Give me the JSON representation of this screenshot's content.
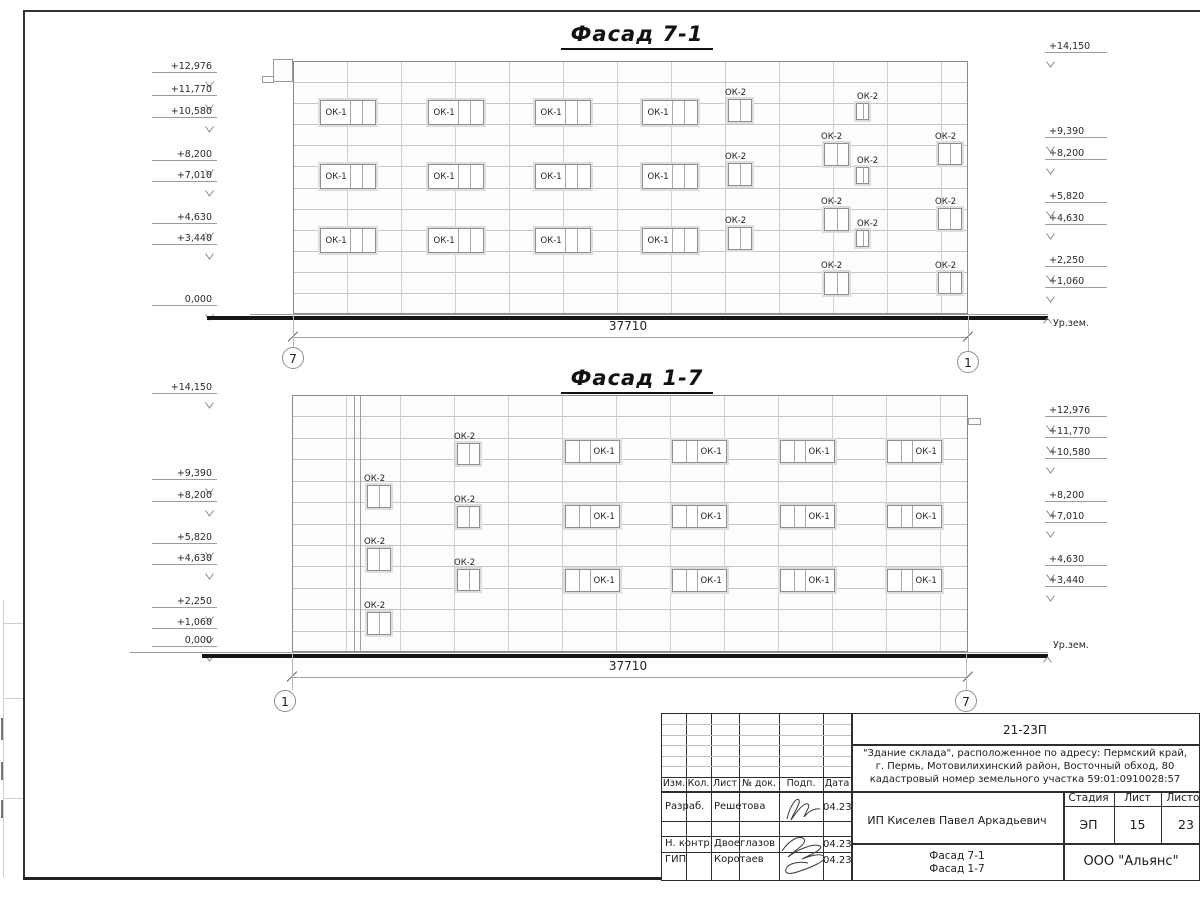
{
  "colors": {
    "line_dark": "#1a1a1a",
    "line_light": "#c4c4c4",
    "frame": "#2e2e2e"
  },
  "facades": [
    {
      "title": "Фасад 7-1",
      "title_cx": 637,
      "title_top": 22,
      "rect": {
        "x0": 293,
        "y0": 61,
        "x1": 968,
        "y1": 314
      },
      "grid": {
        "vstep": 54,
        "rows": 12
      },
      "extra_verticals": [],
      "ledges": [
        {
          "x": 273,
          "y": 59,
          "w": 20,
          "h": 23
        },
        {
          "x": 262,
          "y": 76,
          "w": 12,
          "h": 7
        }
      ],
      "ok1": {
        "label": "ОК-1",
        "cols": [
          320,
          428,
          535,
          642
        ],
        "rows": [
          100,
          164,
          228
        ],
        "w": 56,
        "h": 25,
        "side": "left"
      },
      "ok2": {
        "label": "ОК-2",
        "groups": [
          {
            "x": 728,
            "rows": [
              99,
              163,
              227
            ],
            "w": 24,
            "h": 23
          },
          {
            "x": 824,
            "rows": [
              143,
              208,
              272
            ],
            "w": 25,
            "h": 23
          },
          {
            "x": 856,
            "rows": [
              103,
              167,
              230
            ],
            "w": 13,
            "h": 17
          },
          {
            "x": 938,
            "rows": [
              143,
              208,
              272
            ],
            "w": 24,
            "h": 22
          }
        ]
      },
      "left_marks": [
        {
          "label": "+12,976",
          "y": 67
        },
        {
          "label": "+11,770",
          "y": 90
        },
        {
          "label": "+10,580",
          "y": 112
        },
        {
          "label": "+8,200",
          "y": 155
        },
        {
          "label": "+7,010",
          "y": 176
        },
        {
          "label": "+4,630",
          "y": 218
        },
        {
          "label": "+3,440",
          "y": 239
        },
        {
          "label": "0,000",
          "y": 300
        }
      ],
      "right_marks": [
        {
          "label": "+14,150",
          "y": 47
        },
        {
          "label": "+9,390",
          "y": 132
        },
        {
          "label": "+8,200",
          "y": 154
        },
        {
          "label": "+5,820",
          "y": 197
        },
        {
          "label": "+4,630",
          "y": 219
        },
        {
          "label": "+2,250",
          "y": 261
        },
        {
          "label": "+1,060",
          "y": 282
        }
      ],
      "ground": {
        "thin": {
          "x0": 250,
          "x1": 1048,
          "y": 314
        },
        "thick": {
          "x0": 207,
          "x1": 1048,
          "y": 316
        },
        "label": "Ур.зем.",
        "label_x": 1053,
        "label_y": 324,
        "mark_y": 309
      },
      "dimension": {
        "value": "37710",
        "line_y": 337,
        "label_cx": 628,
        "label_y": 326
      },
      "axes": [
        {
          "label": "7",
          "cx": 293,
          "cy": 358,
          "lx": 293
        },
        {
          "label": "1",
          "cx": 968,
          "cy": 362,
          "lx": 968
        }
      ]
    },
    {
      "title": "Фасад 1-7",
      "title_cx": 637,
      "title_top": 366,
      "rect": {
        "x0": 292,
        "y0": 395,
        "x1": 968,
        "y1": 652
      },
      "grid": {
        "vstep": 54,
        "rows": 12
      },
      "extra_verticals": [
        354,
        360
      ],
      "ledges": [
        {
          "x": 968,
          "y": 418,
          "w": 13,
          "h": 7
        }
      ],
      "ok1": {
        "label": "ОК-1",
        "cols": [
          565,
          672,
          780,
          887
        ],
        "rows": [
          440,
          505,
          569
        ],
        "w": 55,
        "h": 23,
        "side": "right"
      },
      "ok2": {
        "label": "ОК-2",
        "groups": [
          {
            "x": 367,
            "rows": [
              485,
              548,
              612
            ],
            "w": 24,
            "h": 23
          },
          {
            "x": 457,
            "rows": [
              443,
              506,
              569
            ],
            "w": 23,
            "h": 22
          }
        ]
      },
      "left_marks": [
        {
          "label": "+14,150",
          "y": 388
        },
        {
          "label": "+9,390",
          "y": 474
        },
        {
          "label": "+8,200",
          "y": 496
        },
        {
          "label": "+5,820",
          "y": 538
        },
        {
          "label": "+4,630",
          "y": 559
        },
        {
          "label": "+2,250",
          "y": 602
        },
        {
          "label": "+1,060",
          "y": 623
        },
        {
          "label": "0,000",
          "y": 641
        }
      ],
      "right_marks": [
        {
          "label": "+12,976",
          "y": 411
        },
        {
          "label": "+11,770",
          "y": 432
        },
        {
          "label": "+10,580",
          "y": 453
        },
        {
          "label": "+8,200",
          "y": 496
        },
        {
          "label": "+7,010",
          "y": 517
        },
        {
          "label": "+4,630",
          "y": 560
        },
        {
          "label": "+3,440",
          "y": 581
        }
      ],
      "ground": {
        "thin": {
          "x0": 130,
          "x1": 1048,
          "y": 652
        },
        "thick": {
          "x0": 202,
          "x1": 1048,
          "y": 654
        },
        "label": "Ур.зем.",
        "label_x": 1053,
        "label_y": 646,
        "mark_y": 648
      },
      "dimension": {
        "value": "37710",
        "line_y": 677,
        "label_cx": 628,
        "label_y": 666
      },
      "axes": [
        {
          "label": "1",
          "cx": 285,
          "cy": 701,
          "lx": 292
        },
        {
          "label": "7",
          "cx": 966,
          "cy": 701,
          "lx": 966
        }
      ]
    }
  ],
  "titleblock": {
    "doc_number": "21-23П",
    "description_lines": [
      "\"Здание склада\", расположенное по адресу: Пермский край,",
      "г. Пермь, Мотовилихинский район, Восточный обход, 80",
      "кадастровый номер земельного участка 59:01:0910028:57"
    ],
    "columns": [
      "Изм.",
      "Кол.",
      "Лист",
      "№ док.",
      "Подп.",
      "Дата"
    ],
    "signers": [
      {
        "role": "Разраб.",
        "name": "Решетова",
        "date": "04.23"
      },
      {
        "role": "Н. контр.",
        "name": "Двоеглазов",
        "date": "04.23"
      },
      {
        "role": "ГИП",
        "name": "Коротаев",
        "date": "04.23"
      }
    ],
    "client": "ИП Киселев Павел Аркадьевич",
    "stage_label": "Стадия",
    "sheet_label": "Лист",
    "sheets_label": "Листов",
    "stage": "ЭП",
    "sheet_number": "15",
    "sheets_total": "23",
    "drawing_title_lines": [
      "Фасад 7-1",
      "Фасад 1-7"
    ],
    "company": "ООО \"Альянс\""
  }
}
